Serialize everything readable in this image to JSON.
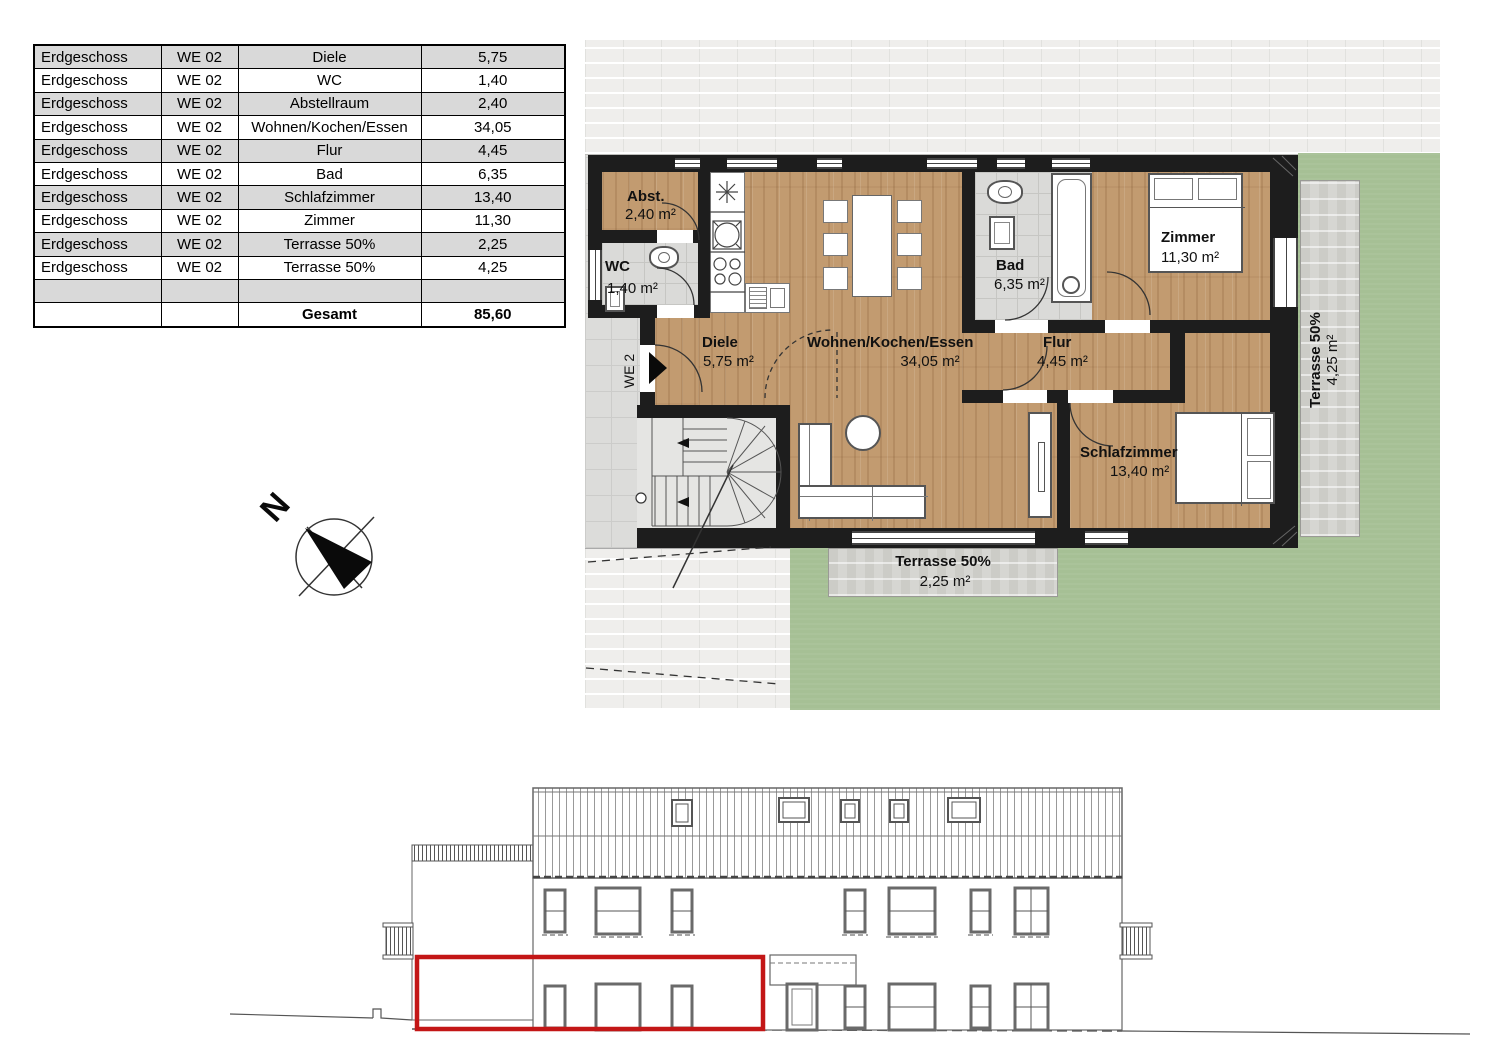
{
  "table": {
    "rows": [
      [
        "Erdgeschoss",
        "WE 02",
        "Diele",
        "5,75"
      ],
      [
        "Erdgeschoss",
        "WE 02",
        "WC",
        "1,40"
      ],
      [
        "Erdgeschoss",
        "WE 02",
        "Abstellraum",
        "2,40"
      ],
      [
        "Erdgeschoss",
        "WE 02",
        "Wohnen/Kochen/Essen",
        "34,05"
      ],
      [
        "Erdgeschoss",
        "WE 02",
        "Flur",
        "4,45"
      ],
      [
        "Erdgeschoss",
        "WE 02",
        "Bad",
        "6,35"
      ],
      [
        "Erdgeschoss",
        "WE 02",
        "Schlafzimmer",
        "13,40"
      ],
      [
        "Erdgeschoss",
        "WE 02",
        "Zimmer",
        "11,30"
      ],
      [
        "Erdgeschoss",
        "WE 02",
        "Terrasse 50%",
        "2,25"
      ],
      [
        "Erdgeschoss",
        "WE 02",
        "Terrasse 50%",
        "4,25"
      ],
      [
        "",
        "",
        "",
        ""
      ],
      [
        "",
        "",
        "Gesamt",
        "85,60"
      ]
    ]
  },
  "plan": {
    "rooms": [
      {
        "name": "Abst.",
        "area": "2,40 m²"
      },
      {
        "name": "WC",
        "area": "1,40 m²"
      },
      {
        "name": "Diele",
        "area": "5,75 m²"
      },
      {
        "name": "Wohnen/Kochen/Essen",
        "area": "34,05 m²"
      },
      {
        "name": "Bad",
        "area": "6,35 m²"
      },
      {
        "name": "Zimmer",
        "area": "11,30 m²"
      },
      {
        "name": "Flur",
        "area": "4,45 m²"
      },
      {
        "name": "Schlafzimmer",
        "area": "13,40 m²"
      },
      {
        "name": "Terrasse 50%",
        "area": "2,25 m²"
      },
      {
        "name": "Terrasse 50%",
        "area": "4,25 m²"
      }
    ],
    "unit_label": "WE 2",
    "compass_north": "N"
  },
  "colors": {
    "wall": "#1d1d1d",
    "wood": "#c29b70",
    "lawn": "#a6c095",
    "tile": "#dadad8",
    "terrace": "#d6d6d2",
    "brick_paving": "#efeeec",
    "table_row_alt": "#d9d9d9",
    "highlight_red": "#c31616"
  }
}
